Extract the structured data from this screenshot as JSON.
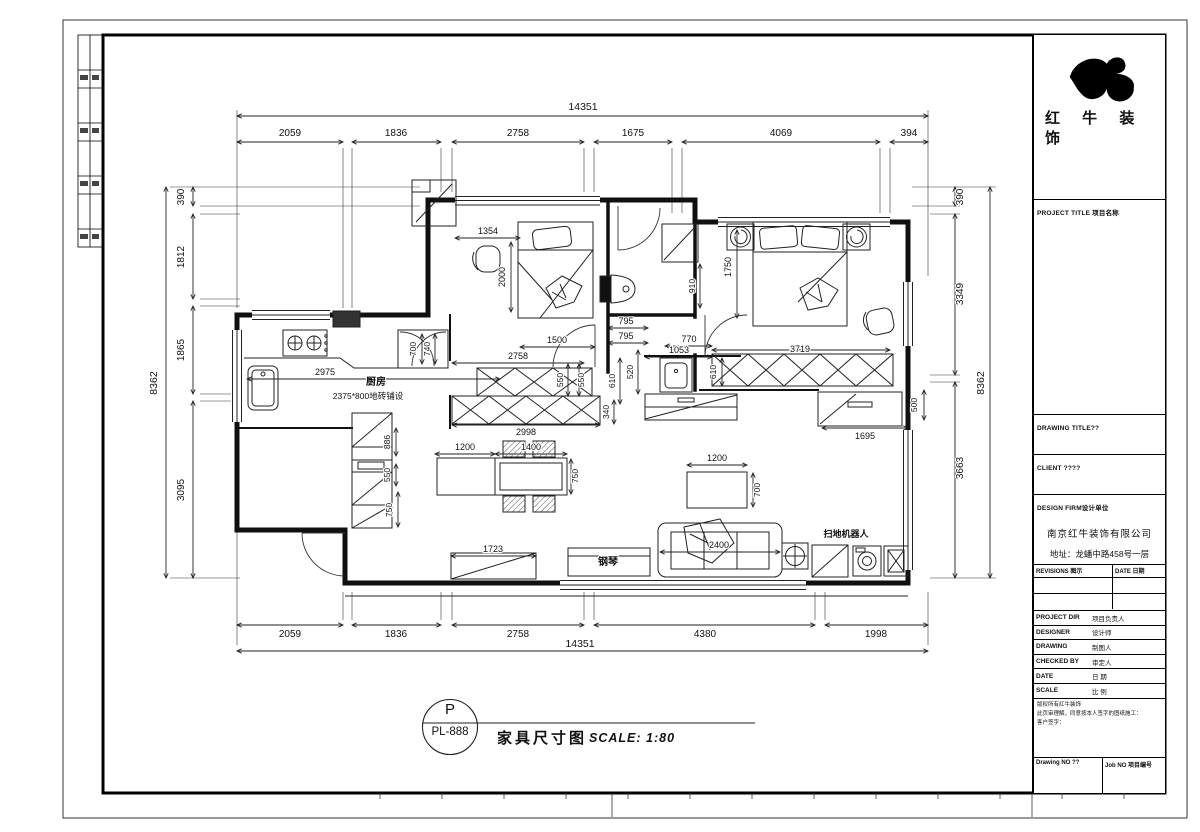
{
  "title_block": {
    "company_line1": "红 牛 装",
    "company_line2": "饰",
    "project_title": "PROJECT TITLE 项目名称",
    "drawing_title": "DRAWING TITLE??",
    "client": "CLIENT ????",
    "design_firm": "DESIGN FIRM设计单位",
    "firm_name": "南京红牛装饰有限公司",
    "firm_address": "地址：龙蟠中路458号一层",
    "revisions": "REVISIONS 图示",
    "date_col": "DATE 日期",
    "rows": [
      {
        "en": "PROJECT DIR",
        "cn": "项目负责人"
      },
      {
        "en": "DESIGNER",
        "cn": "设计师"
      },
      {
        "en": "DRAWING",
        "cn": "制图人"
      },
      {
        "en": "CHECKED BY",
        "cn": "审定人"
      },
      {
        "en": "DATE",
        "cn": "日 期"
      },
      {
        "en": "SCALE",
        "cn": "比 例"
      }
    ],
    "note1": "版权所有红牛装饰",
    "note2": "此页审理解，同意按本人签字的图纸施工：",
    "note3": "客户签字：",
    "drawing_no": "Drawing NO ??",
    "job_no": "Job NO 项目编号"
  },
  "drawing_label": {
    "code_top": "P",
    "code_bottom": "PL-888",
    "title": "家具尺寸图",
    "scale": "SCALE: 1:80"
  },
  "plan": {
    "room_labels": [
      {
        "t": "厨房",
        "x": 376,
        "y": 385,
        "s": 10,
        "b": 1
      },
      {
        "t": "2375*800地砖铺设",
        "x": 368,
        "y": 399,
        "s": 8.5
      },
      {
        "t": "钢琴",
        "x": 608,
        "y": 565,
        "s": 10,
        "b": 1
      },
      {
        "t": "扫地机器人",
        "x": 846,
        "y": 537,
        "s": 9,
        "b": 1
      }
    ],
    "dim_labels": [
      {
        "t": "14351",
        "x": 583,
        "y": 110,
        "s": 10.5
      },
      {
        "t": "2059",
        "x": 290,
        "y": 136,
        "s": 10
      },
      {
        "t": "1836",
        "x": 396,
        "y": 136,
        "s": 10
      },
      {
        "t": "2758",
        "x": 518,
        "y": 136,
        "s": 10
      },
      {
        "t": "1675",
        "x": 633,
        "y": 136,
        "s": 10
      },
      {
        "t": "4069",
        "x": 781,
        "y": 136,
        "s": 10
      },
      {
        "t": "394",
        "x": 909,
        "y": 136,
        "s": 10
      },
      {
        "t": "2059",
        "x": 290,
        "y": 637,
        "s": 10
      },
      {
        "t": "1836",
        "x": 396,
        "y": 637,
        "s": 10
      },
      {
        "t": "2758",
        "x": 518,
        "y": 637,
        "s": 10
      },
      {
        "t": "4380",
        "x": 705,
        "y": 637,
        "s": 10
      },
      {
        "t": "1998",
        "x": 876,
        "y": 637,
        "s": 10
      },
      {
        "t": "14351",
        "x": 580,
        "y": 647,
        "s": 10.5
      },
      {
        "t": "390",
        "x": 184,
        "y": 197,
        "r": 1,
        "s": 10
      },
      {
        "t": "1812",
        "x": 184,
        "y": 257,
        "r": 1,
        "s": 10
      },
      {
        "t": "1865",
        "x": 184,
        "y": 350,
        "r": 1,
        "s": 10
      },
      {
        "t": "3095",
        "x": 184,
        "y": 490,
        "r": 1,
        "s": 10
      },
      {
        "t": "8362",
        "x": 157,
        "y": 383,
        "r": 1,
        "s": 10.5
      },
      {
        "t": "390",
        "x": 963,
        "y": 197,
        "r": 1,
        "s": 10
      },
      {
        "t": "3349",
        "x": 963,
        "y": 294,
        "r": 1,
        "s": 10
      },
      {
        "t": "3663",
        "x": 963,
        "y": 468,
        "r": 1,
        "s": 10
      },
      {
        "t": "8362",
        "x": 984,
        "y": 383,
        "r": 1,
        "s": 10.5
      },
      {
        "t": "1354",
        "x": 488,
        "y": 234
      },
      {
        "t": "2000",
        "x": 505,
        "y": 277,
        "r": 1
      },
      {
        "t": "1500",
        "x": 557,
        "y": 343
      },
      {
        "t": "2758",
        "x": 518,
        "y": 359
      },
      {
        "t": "550",
        "x": 563,
        "y": 380,
        "r": 1,
        "s": 8.5
      },
      {
        "t": "550",
        "x": 584,
        "y": 380,
        "r": 1,
        "s": 8.5
      },
      {
        "t": "340",
        "x": 609,
        "y": 412,
        "r": 1,
        "s": 8.5
      },
      {
        "t": "610",
        "x": 615,
        "y": 381,
        "r": 1,
        "s": 8.5
      },
      {
        "t": "520",
        "x": 633,
        "y": 372,
        "r": 1,
        "s": 8.5
      },
      {
        "t": "795",
        "x": 626,
        "y": 324
      },
      {
        "t": "795",
        "x": 626,
        "y": 339
      },
      {
        "t": "770",
        "x": 689,
        "y": 342
      },
      {
        "t": "1053",
        "x": 679,
        "y": 353
      },
      {
        "t": "910",
        "x": 695,
        "y": 286,
        "r": 1,
        "s": 8.5
      },
      {
        "t": "1750",
        "x": 731,
        "y": 267,
        "r": 1
      },
      {
        "t": "3719",
        "x": 800,
        "y": 352
      },
      {
        "t": "610",
        "x": 716,
        "y": 372,
        "r": 1,
        "s": 8.5
      },
      {
        "t": "2998",
        "x": 526,
        "y": 435
      },
      {
        "t": "886",
        "x": 390,
        "y": 442,
        "r": 1,
        "s": 8.5
      },
      {
        "t": "550",
        "x": 390,
        "y": 475,
        "r": 1,
        "s": 8.5
      },
      {
        "t": "750",
        "x": 392,
        "y": 510,
        "r": 1,
        "s": 8.5
      },
      {
        "t": "1200",
        "x": 465,
        "y": 450
      },
      {
        "t": "1400",
        "x": 531,
        "y": 450
      },
      {
        "t": "750",
        "x": 578,
        "y": 476,
        "r": 1,
        "s": 8.5
      },
      {
        "t": "1723",
        "x": 493,
        "y": 552
      },
      {
        "t": "1200",
        "x": 717,
        "y": 461
      },
      {
        "t": "700",
        "x": 760,
        "y": 490,
        "r": 1,
        "s": 8.5
      },
      {
        "t": "2400",
        "x": 719,
        "y": 548
      },
      {
        "t": "1695",
        "x": 865,
        "y": 439
      },
      {
        "t": "500",
        "x": 917,
        "y": 405,
        "r": 1,
        "s": 8.5
      },
      {
        "t": "2975",
        "x": 325,
        "y": 375
      },
      {
        "t": "700",
        "x": 416,
        "y": 349,
        "r": 1,
        "s": 8.5
      },
      {
        "t": "740",
        "x": 430,
        "y": 349,
        "r": 1,
        "s": 8.5
      }
    ]
  }
}
